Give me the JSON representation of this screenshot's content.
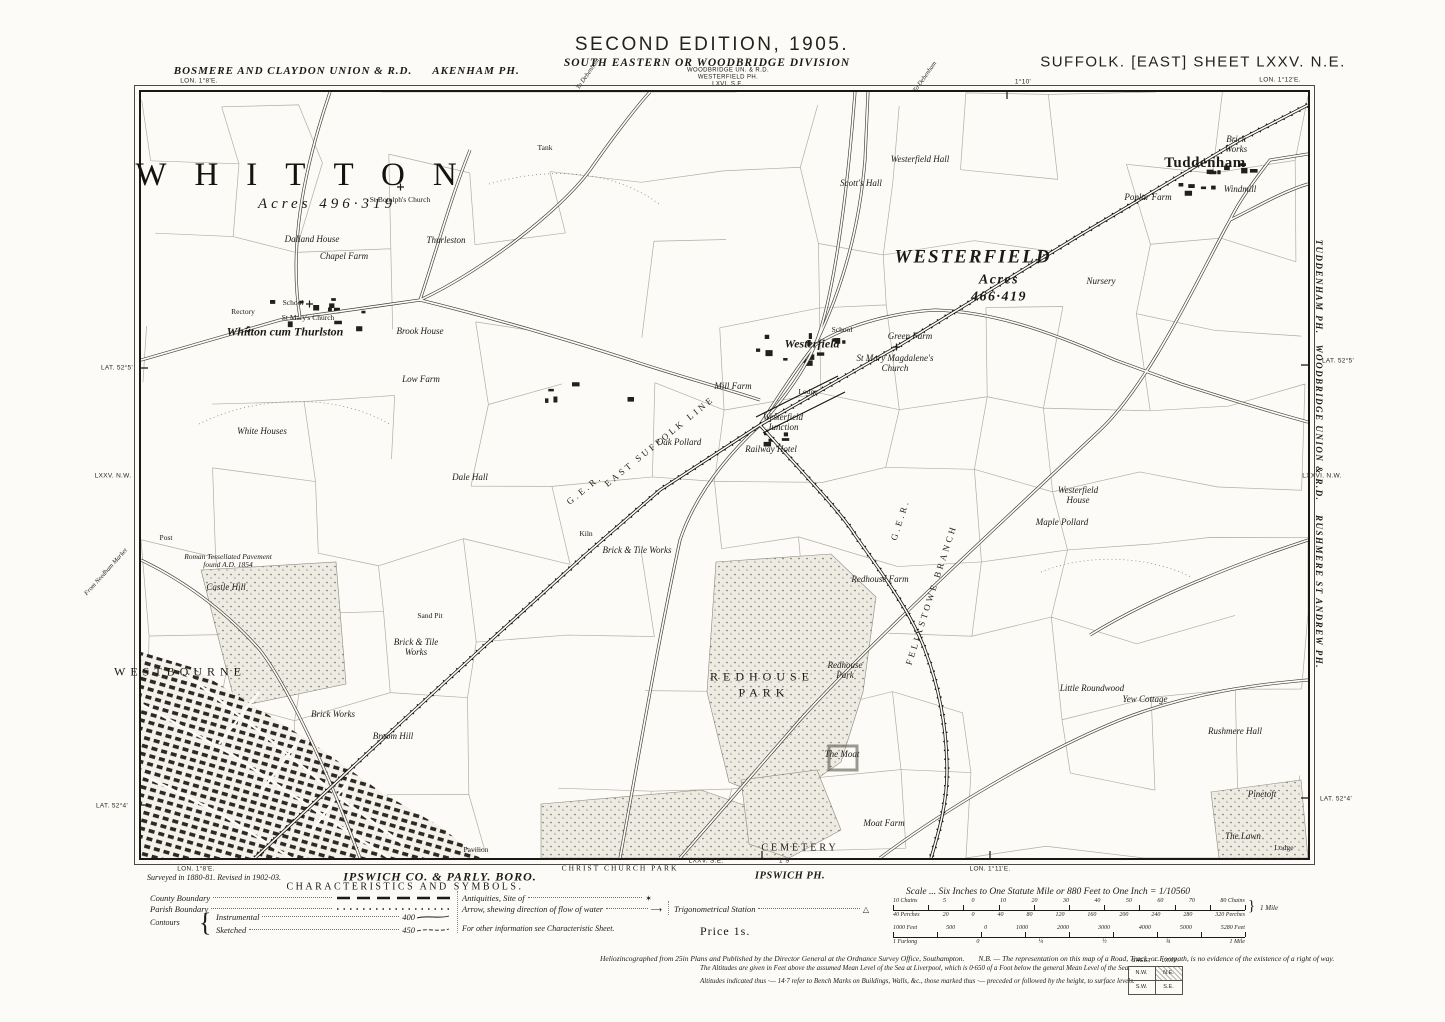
{
  "page": {
    "bg": "#fcfbf7",
    "ink": "#1c1b16"
  },
  "header": {
    "edition": "SECOND EDITION, 1905.",
    "division": "SOUTH EASTERN OR WOODBRIDGE DIVISION",
    "admin_stack": [
      "WOODBRIDGE UN. & R.D.",
      "WESTERFIELD PH.",
      "LXVI. S.E."
    ],
    "union_left": "BOSMERE AND CLAYDON UNION & R.D.",
    "parish_left": "AKENHAM PH.",
    "sheet_title": "SUFFOLK. [EAST] SHEET LXXV. N.E.",
    "lon_left": "LON. 1°8'E.",
    "lon_mid": "1°10'",
    "lon_right": "LON. 1°12'E.",
    "route_left": "To Debenham",
    "route_right": "To Debenham"
  },
  "margin_left": {
    "lat_top": "LAT. 52°5'",
    "adjacent_sheet": "LXXV. N.W.",
    "route": "From Needham Market",
    "lat_bottom": "LAT. 52°4'"
  },
  "margin_right": {
    "parish_top": "TUDDENHAM PH.",
    "lat_top": "LAT. 52°5'",
    "union": "WOODBRIDGE UNION & R.D.",
    "adjacent_sheet": "LXXVI. N.W.",
    "parish_bottom": "RUSHMERE ST ANDREW PH.",
    "lat_bottom": "LAT. 52°4'"
  },
  "margin_bottom": {
    "adjacent_sheet": "LXXV. S.E.",
    "lon_left": "LON. 1°8'E.",
    "lon_mid": "1°9'",
    "lon_right": "LON. 1°11'E.",
    "boro": "IPSWICH CO. & PARLY. BORO.",
    "park": "CHRIST CHURCH PARK",
    "parish": "IPSWICH PH.",
    "survey_note": "Surveyed in 1880-81.  Revised in 1902-03."
  },
  "legend": {
    "title": "CHARACTERISTICS AND SYMBOLS.",
    "county_boundary": "County Boundary",
    "parish_boundary": "Parish Boundary",
    "contours": "Contours",
    "instrumental": "Instrumental",
    "sketched": "Sketched",
    "contour_val_1": "400",
    "contour_val_2": "450",
    "antiquities": "Antiquities, Site of",
    "antiquities_sym": "✶",
    "arrow": "Arrow, shewing direction of flow of water",
    "arrow_sym": "⟶",
    "trig": "Trigonometrical Station",
    "trig_sym": "△",
    "footnote": "For other information see Characteristic Sheet."
  },
  "price": "Price 1s.",
  "scale": {
    "caption": "Scale ... Six Inches to One Statute Mile or 880 Feet to One Inch = 1/10560",
    "bar1_top": [
      "10 Chains",
      "5",
      "0",
      "10",
      "20",
      "30",
      "40",
      "50",
      "60",
      "70",
      "80 Chains"
    ],
    "bar1_bottom": [
      "40 Perches",
      "20",
      "0",
      "40",
      "80",
      "120",
      "160",
      "200",
      "240",
      "280",
      "320 Perches"
    ],
    "bar1_mile": "1 Mile",
    "bar2_top": [
      "1000 Feet",
      "500",
      "0",
      "1000",
      "2000",
      "3000",
      "4000",
      "5000",
      "5280 Feet"
    ],
    "bar2_bottom": [
      "1 Furlong",
      "0",
      "¼",
      "½",
      "¾",
      "1 Mile"
    ]
  },
  "imprint": {
    "line1a": "Heliozincographed from 25in Plans and Published by the Director General at the Ordnance Survey Office, Southampton.",
    "line1b": "N.B. — The representation on this map of a Road, Track, or Footpath, is no evidence of the existence of a right of way.",
    "line2": "The Altitudes are given in Feet above the assumed Mean Level of the Sea at Liverpool, which is 0·650 of a Foot below the general Mean Level of the Sea.",
    "line3": "Altitudes indicated thus ·— 14·7 refer to Bench Marks on Buildings, Walls, &c., those marked thus ·— preceded or followed by the height, to surface levels."
  },
  "sheet_index": {
    "label": "SHEET — LXXV.",
    "nw": "N.W.",
    "ne": "N.E.",
    "sw": "S.W.",
    "se": "S.E."
  },
  "map": {
    "labels": [
      {
        "x": 169,
        "y": 83,
        "t": "WHITTON",
        "c": "town"
      },
      {
        "x": 186,
        "y": 112,
        "t": "Acres 496·319",
        "c": "acres"
      },
      {
        "x": 832,
        "y": 166,
        "t": "WESTERFIELD",
        "c": "town2"
      },
      {
        "x": 858,
        "y": 188,
        "t": "Acres",
        "c": "acres2"
      },
      {
        "x": 858,
        "y": 205,
        "t": "466·419",
        "c": "acres2"
      },
      {
        "x": 1064,
        "y": 71,
        "t": "Tuddenham",
        "c": "hamlet"
      },
      {
        "x": 144,
        "y": 240,
        "t": "Whitton cum Thurlston",
        "c": "vill"
      },
      {
        "x": 671,
        "y": 252,
        "t": "Westerfield",
        "c": "vill"
      },
      {
        "x": 39,
        "y": 580,
        "t": "WESTBOURNE",
        "c": "area"
      },
      {
        "x": 621,
        "y": 585,
        "t": "REDHOUSE",
        "c": "area"
      },
      {
        "x": 623,
        "y": 601,
        "t": "PARK",
        "c": "area"
      },
      {
        "x": 659,
        "y": 756,
        "t": "CEMETERY",
        "c": "area2"
      },
      {
        "x": 85,
        "y": 496,
        "t": "Castle Hill",
        "c": "hse"
      },
      {
        "x": 275,
        "y": 556,
        "t": "Brick & Tile\nWorks",
        "c": "hse mult"
      },
      {
        "x": 496,
        "y": 459,
        "t": "Brick & Tile Works",
        "c": "hse"
      },
      {
        "x": 445,
        "y": 442,
        "t": "Kiln",
        "c": "hse2"
      },
      {
        "x": 592,
        "y": 295,
        "t": "Mill Farm",
        "c": "hse"
      },
      {
        "x": 642,
        "y": 331,
        "t": "Westerfield\nJunction",
        "c": "hse mult"
      },
      {
        "x": 630,
        "y": 358,
        "t": "Railway Hotel",
        "c": "hse"
      },
      {
        "x": 779,
        "y": 68,
        "t": "Westerfield Hall",
        "c": "hse"
      },
      {
        "x": 720,
        "y": 92,
        "t": "Scott's Hall",
        "c": "hse"
      },
      {
        "x": 769,
        "y": 245,
        "t": "Green Farm",
        "c": "hse"
      },
      {
        "x": 754,
        "y": 272,
        "t": "St Mary Magdalene's\nChurch",
        "c": "hse mult"
      },
      {
        "x": 167,
        "y": 226,
        "t": "St Mary's Church",
        "c": "hse2"
      },
      {
        "x": 102,
        "y": 220,
        "t": "Rectory",
        "c": "hse2"
      },
      {
        "x": 152,
        "y": 211,
        "t": "School",
        "c": "hse2"
      },
      {
        "x": 259,
        "y": 108,
        "t": "St Botolph's Church",
        "c": "hse2"
      },
      {
        "x": 305,
        "y": 149,
        "t": "Thurleston",
        "c": "hse"
      },
      {
        "x": 203,
        "y": 165,
        "t": "Chapel Farm",
        "c": "hse"
      },
      {
        "x": 171,
        "y": 148,
        "t": "Dalland House",
        "c": "hse"
      },
      {
        "x": 279,
        "y": 240,
        "t": "Brook House",
        "c": "hse"
      },
      {
        "x": 280,
        "y": 288,
        "t": "Low Farm",
        "c": "hse"
      },
      {
        "x": 121,
        "y": 340,
        "t": "White Houses",
        "c": "hse"
      },
      {
        "x": 329,
        "y": 386,
        "t": "Dale Hall",
        "c": "hse"
      },
      {
        "x": 87,
        "y": 469,
        "t": "Roman Tessellated Pavement\nfound A.D. 1854",
        "c": "tiny mult"
      },
      {
        "x": 289,
        "y": 524,
        "t": "Sand Pit",
        "c": "hse2"
      },
      {
        "x": 739,
        "y": 488,
        "t": "Redhouse Farm",
        "c": "hse"
      },
      {
        "x": 704,
        "y": 579,
        "t": "Redhouse\nPark",
        "c": "hse mult"
      },
      {
        "x": 701,
        "y": 663,
        "t": "The Moat",
        "c": "hse"
      },
      {
        "x": 743,
        "y": 732,
        "t": "Moat Farm",
        "c": "hse"
      },
      {
        "x": 951,
        "y": 597,
        "t": "Little Roundwood",
        "c": "hse"
      },
      {
        "x": 1004,
        "y": 608,
        "t": "Yew Cottage",
        "c": "hse"
      },
      {
        "x": 1094,
        "y": 640,
        "t": "Rushmere Hall",
        "c": "hse"
      },
      {
        "x": 1121,
        "y": 703,
        "t": "Pinetoft",
        "c": "hse"
      },
      {
        "x": 1102,
        "y": 745,
        "t": "The Lawn",
        "c": "hse"
      },
      {
        "x": 1143,
        "y": 756,
        "t": "Lodge",
        "c": "hse2"
      },
      {
        "x": 1007,
        "y": 106,
        "t": "Poplar Farm",
        "c": "hse"
      },
      {
        "x": 1095,
        "y": 53,
        "t": "Brick\nWorks",
        "c": "hse mult"
      },
      {
        "x": 1099,
        "y": 98,
        "t": "Windmill",
        "c": "hse"
      },
      {
        "x": 960,
        "y": 190,
        "t": "Nursery",
        "c": "hse"
      },
      {
        "x": 701,
        "y": 238,
        "t": "School",
        "c": "hse2"
      },
      {
        "x": 667,
        "y": 300,
        "t": "Lodge",
        "c": "hse2"
      },
      {
        "x": 538,
        "y": 351,
        "t": "Oak Pollard",
        "c": "hse"
      },
      {
        "x": 921,
        "y": 431,
        "t": "Maple Pollard",
        "c": "hse"
      },
      {
        "x": 937,
        "y": 404,
        "t": "Westerfield\nHouse",
        "c": "hse mult"
      },
      {
        "x": 404,
        "y": 56,
        "t": "Tank",
        "c": "hse2"
      },
      {
        "x": 444,
        "y": 398,
        "t": "G.E.R.",
        "c": "rail",
        "r": -39
      },
      {
        "x": 519,
        "y": 350,
        "t": "EAST SUFFOLK LINE",
        "c": "rail",
        "r": -39
      },
      {
        "x": 760,
        "y": 428,
        "t": "G.E.R.",
        "c": "rail",
        "r": -72
      },
      {
        "x": 791,
        "y": 503,
        "t": "FELIXSTOWE BRANCH",
        "c": "rail",
        "r": -72
      },
      {
        "x": 25,
        "y": 446,
        "t": "Post",
        "c": "hse2"
      },
      {
        "x": 252,
        "y": 645,
        "t": "Broom Hill",
        "c": "hse"
      },
      {
        "x": 192,
        "y": 623,
        "t": "Brick Works",
        "c": "hse"
      },
      {
        "x": 335,
        "y": 758,
        "t": "Pavilion",
        "c": "hse2"
      }
    ]
  }
}
